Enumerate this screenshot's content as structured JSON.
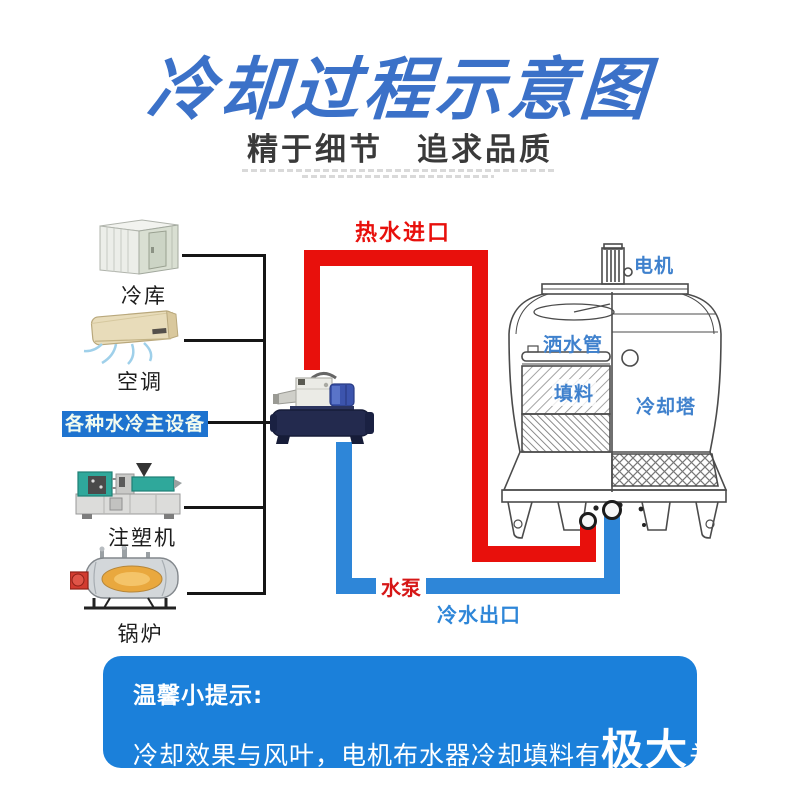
{
  "header": {
    "title": "冷却过程示意图",
    "subtitle_left": "精于细节",
    "subtitle_right": "追求品质"
  },
  "equipment": {
    "group_label": "各种水冷主设备",
    "items": [
      {
        "label": "冷库"
      },
      {
        "label": "空调"
      },
      {
        "label": "注塑机"
      },
      {
        "label": "锅炉"
      }
    ]
  },
  "flow": {
    "hot_inlet": "热水进口",
    "pump": "水泵",
    "cold_outlet": "冷水出口"
  },
  "tower": {
    "motor": "电机",
    "sprinkler": "洒水管",
    "filler": "填料",
    "name": "冷却塔"
  },
  "tip": {
    "heading": "温馨小提示:",
    "body_prefix": "冷却效果与风叶，电机布水器冷却填料有",
    "body_emphasis": "极大",
    "body_suffix": "关系"
  },
  "colors": {
    "title_blue": "#3b71c8",
    "hot_red": "#e8100c",
    "cold_blue": "#2e86d8",
    "group_label_bg": "#1e73cf",
    "tip_bg": "#1b80da",
    "tower_label_blue": "#3f81cd"
  }
}
